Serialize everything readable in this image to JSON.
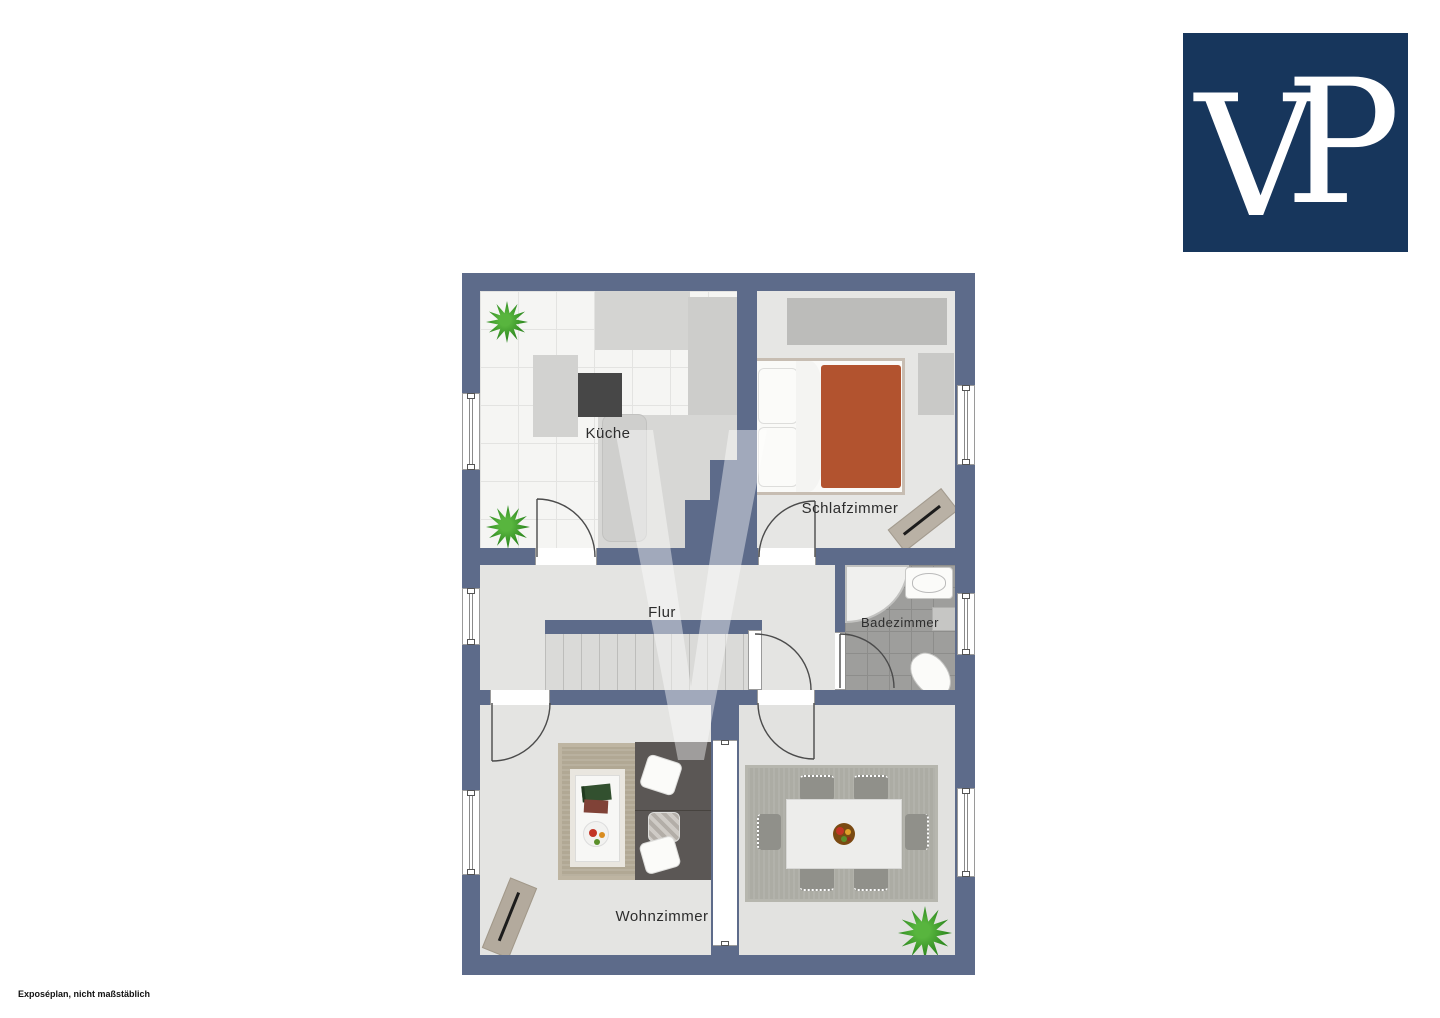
{
  "logo": {
    "v": "V",
    "p": "P",
    "bg_color": "#17365c"
  },
  "footer": {
    "note": "Exposéplan, nicht maßstäblich"
  },
  "watermark": {
    "text": "V"
  },
  "rooms": {
    "kueche": {
      "label": "Küche"
    },
    "schlafzimmer": {
      "label": "Schlafzimmer"
    },
    "flur": {
      "label": "Flur"
    },
    "badezimmer": {
      "label": "Badezimmer"
    },
    "wohnzimmer": {
      "label": "Wohnzimmer"
    }
  },
  "furniture": {
    "kitchen": [
      "island-with-stove",
      "counter",
      "plants"
    ],
    "bedroom": [
      "double-bed",
      "wardrobe",
      "dresser",
      "sideboard"
    ],
    "bath": [
      "shower",
      "sink",
      "toilet",
      "cabinet"
    ],
    "living": [
      "sofa",
      "rug",
      "coffee-table",
      "sideboard"
    ],
    "dining": [
      "table",
      "six-chairs",
      "rug",
      "plant"
    ]
  },
  "colors": {
    "wall": "#5d6b8a",
    "logo_bg": "#17365c",
    "floor_light": "#e4e4e2",
    "kitchen_tile": "#f5f5f3",
    "bath_tile": "#9e9e9c",
    "bed_blanket": "#b2532f",
    "plant_green": "#2f8a20",
    "sofa_gray": "#5b5755"
  }
}
